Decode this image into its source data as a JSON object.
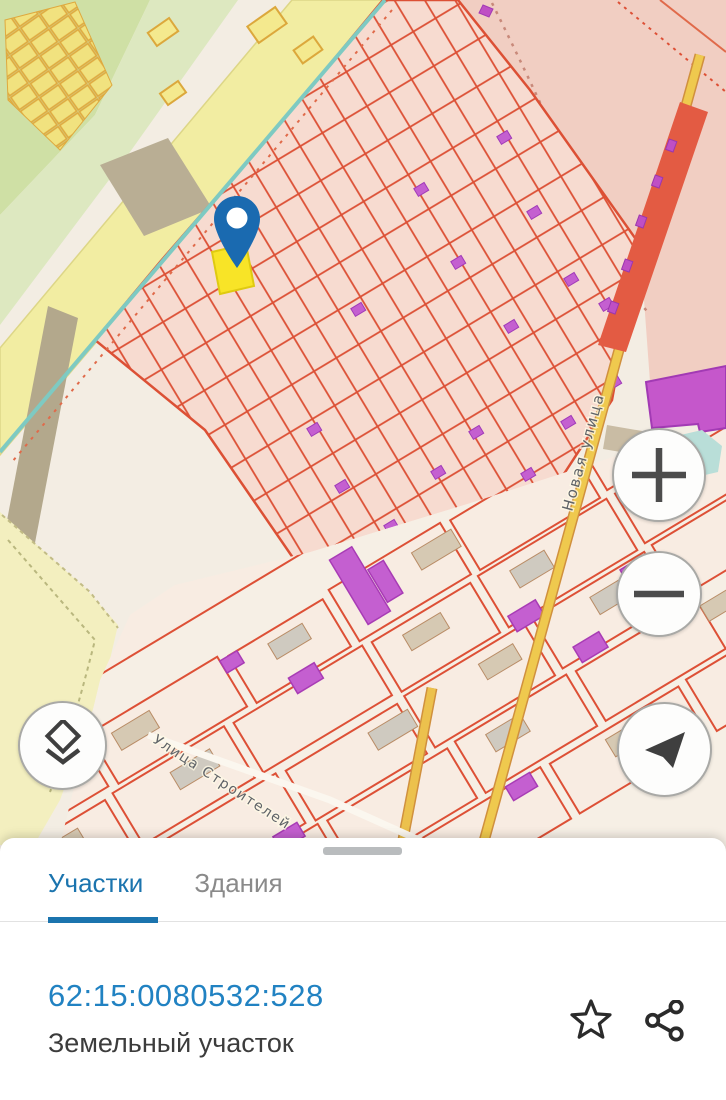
{
  "map": {
    "street_labels": [
      {
        "text": "Новая улица"
      },
      {
        "text": "Улица Строителей"
      }
    ],
    "marker": {
      "name": "selected-parcel-pin"
    },
    "controls": {
      "zoom_in": "plus",
      "zoom_out": "minus",
      "layers": "layers",
      "compass": "location-arrow"
    }
  },
  "bottom_sheet": {
    "tabs": [
      {
        "label": "Участки",
        "active": true
      },
      {
        "label": "Здания",
        "active": false
      }
    ],
    "parcel": {
      "cadastral_number": "62:15:0080532:528",
      "type_label": "Земельный участок"
    },
    "actions": [
      {
        "name": "favorite",
        "icon": "star-outline"
      },
      {
        "name": "share",
        "icon": "share-nodes"
      }
    ]
  },
  "colors": {
    "accent_blue": "#1b74ae",
    "link_blue": "#2182c2",
    "pin_blue": "#1a6ab0",
    "selected_parcel_yellow": "#f8e427",
    "parcel_line_red": "#dd5036",
    "building_purple": "#c45fd0",
    "map_pink": "#f7dbd0",
    "map_dark_pink": "#f1cec2",
    "road_yellow": "#efc94e",
    "teal_line": "#7ecac2"
  }
}
